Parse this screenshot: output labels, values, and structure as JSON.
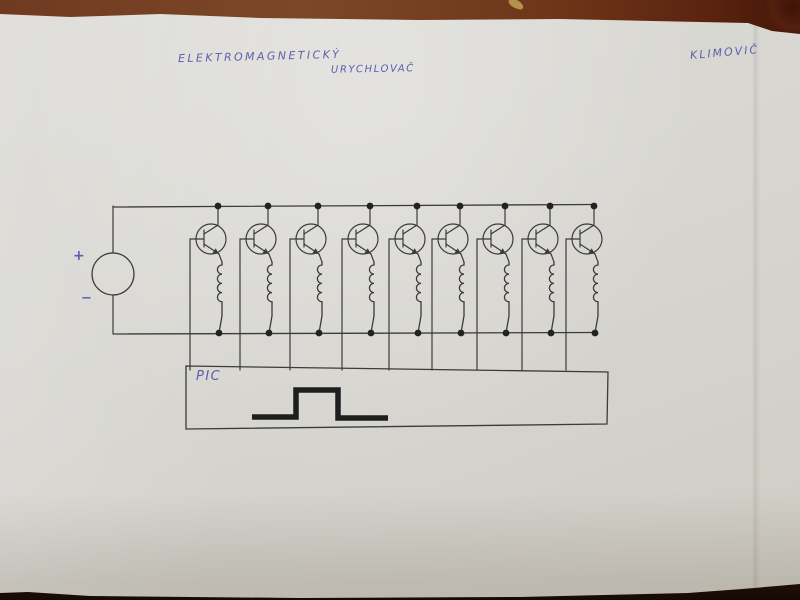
{
  "texts": {
    "title_line1": "ELEKTROMAGNETICKÝ",
    "title_line2": "URYCHLOVAČ",
    "author": "KLIMOVIČ"
  },
  "schematic": {
    "kind": "electromagnetic-accelerator coil driver, 9 transistor stages with coils fed from one supply, bases driven by PIC pulse",
    "ink": "#3b3b3e",
    "pen": "#5b5fae",
    "pulse_ink": "#1e1e1e",
    "stage_count": 9,
    "stage_dot_x": [
      218,
      268,
      318,
      370,
      417,
      460,
      505,
      550,
      594
    ],
    "top_rail_y": 206,
    "bottom_rail_y": 333,
    "rail_left_x": 113,
    "source": {
      "cx": 113,
      "cy": 274,
      "r": 21,
      "plus_label": "+",
      "minus_label": "−"
    },
    "transistor": {
      "circle_dx": -7,
      "cy": 239,
      "r": 15,
      "base_offset": 28
    },
    "coil": {
      "top_y": 262,
      "bumps": 4,
      "bump_r": 4.6,
      "x_offset": 4
    },
    "controller": {
      "label": "PIC",
      "box_points": "186,366 608,372 607,424 186,429",
      "box_top_y": 366
    },
    "pulse_points": "252,417 296,417 296,390 338,390 338,418 388,418"
  },
  "palette": {
    "table": "#6f3a20",
    "table_dark": "#46220f",
    "paper": "#d8d7d2",
    "bottom_shadow": "#170a04"
  }
}
